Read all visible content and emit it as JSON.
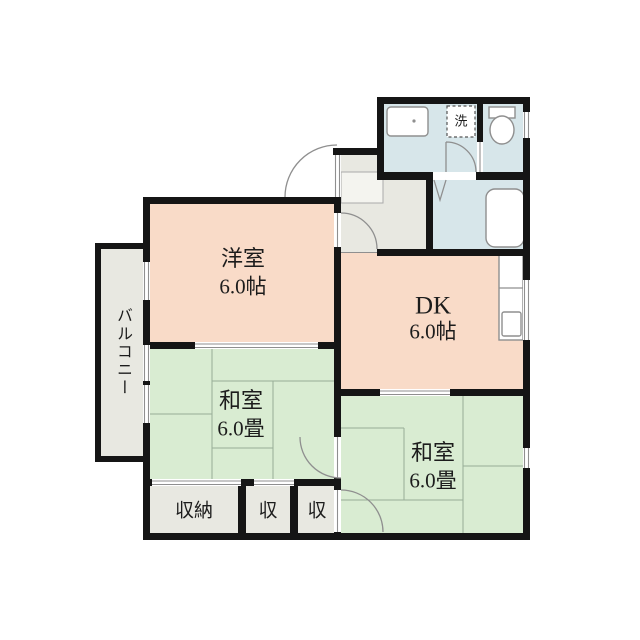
{
  "palette": {
    "room_pink": "#f9dbc8",
    "room_green": "#d9ecd2",
    "wet_blue": "#d7e6ea",
    "gray_zone": "#e8e8e1",
    "genkan": "#f4f4ef",
    "wall": "#151515",
    "line": "#8f8f8f",
    "tatami": "#97ad97",
    "fixture": "#8f8f8f"
  },
  "rooms": {
    "western_room": {
      "label": "洋室",
      "size": "6.0帖"
    },
    "dining_kitchen": {
      "label": "DK",
      "size": "6.0帖"
    },
    "japanese_room_upper": {
      "label": "和室",
      "size": "6.0畳"
    },
    "japanese_room_lower": {
      "label": "和室",
      "size": "6.0畳"
    },
    "balcony": {
      "label": "バルコニー"
    },
    "closet_large": {
      "label": "収納"
    },
    "closet_mid": {
      "label": "収"
    },
    "closet_small": {
      "label": "収"
    },
    "washer_space": {
      "label": "洗"
    }
  }
}
